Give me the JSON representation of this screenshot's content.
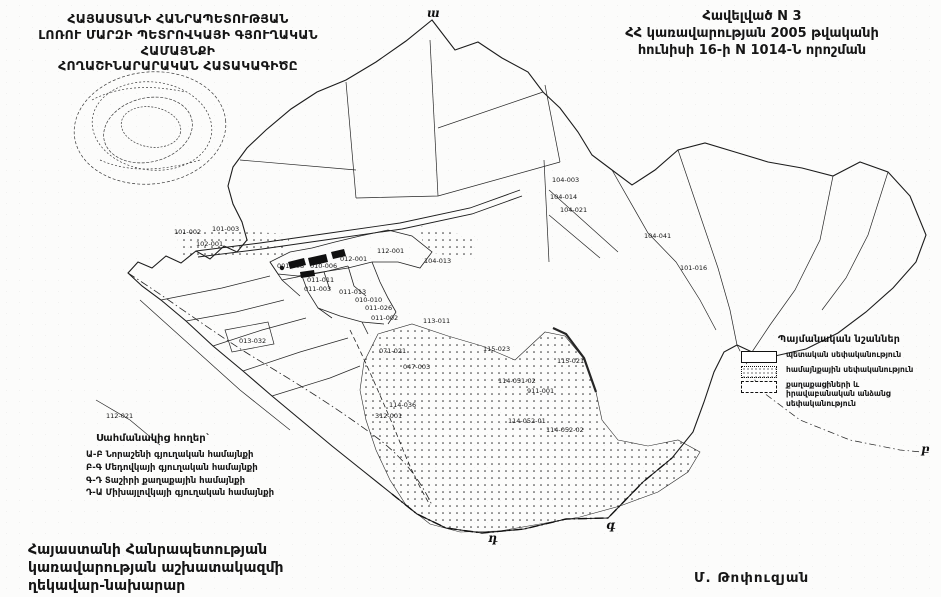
{
  "title": {
    "lines": [
      "ՀԱՅԱՍՏԱՆԻ ՀԱՆՐԱՊԵՏՈՒԹՅԱՆ",
      "ԼՈՌՈՒ ՄԱՐԶԻ ՊԵՏՐՈՎԿԱՅԻ ԳՅՈՒՂԱԿԱՆ ՀԱՄԱՅՆՔԻ",
      "ՀՈՂԱՇԻՆԱՐԱՐԱԿԱՆ ՀԱՏԱԿԱԳԻԾԸ"
    ]
  },
  "decree": {
    "lines": [
      "Հավելված N 3",
      "ՀՀ կառավարության 2005 թվականի",
      "հունիսի 16-ի N 1014-Ն որոշման"
    ]
  },
  "legend": {
    "header": "Պայմանական նշաններ",
    "items": [
      {
        "symbol": "solid-box-icon",
        "label": "պետական սեփականություն"
      },
      {
        "symbol": "dotted-box-icon",
        "label": "համայնքային սեփականություն"
      },
      {
        "symbol": "dashed-box-icon",
        "label": "քաղաքացիների և իրավաբանական անձանց սեփականություն"
      }
    ]
  },
  "neighbors": {
    "header": "Սահմանակից հողեր`",
    "items": [
      "Ա-Բ Նորաշենի գյուղական համայնքի",
      "Բ-Գ Մեդովկայի գյուղական համայնքի",
      "Գ-Դ Տաշիրի քաղաքային համայնքի",
      "Դ-Ա Միխայլովկայի գյուղական համայնքի"
    ]
  },
  "signatory": {
    "lines": [
      "Հայաստանի Հանրապետության",
      "կառավարության աշխատակազմի",
      "ղեկավար-նախարար"
    ],
    "name": "Մ. Թոփուզյան"
  },
  "map": {
    "boundary_letters": [
      {
        "char": "ա",
        "x": 427,
        "y": 6
      },
      {
        "char": "բ",
        "x": 921,
        "y": 442
      },
      {
        "char": "գ",
        "x": 606,
        "y": 518
      },
      {
        "char": "դ",
        "x": 488,
        "y": 531
      }
    ],
    "parcel_labels": [
      {
        "text": "104-003",
        "x": 552,
        "y": 177
      },
      {
        "text": "104-014",
        "x": 550,
        "y": 194
      },
      {
        "text": "104-021",
        "x": 560,
        "y": 207
      },
      {
        "text": "104-041",
        "x": 644,
        "y": 233
      },
      {
        "text": "101-016",
        "x": 680,
        "y": 265
      },
      {
        "text": "101-002",
        "x": 174,
        "y": 229
      },
      {
        "text": "101-003",
        "x": 212,
        "y": 226
      },
      {
        "text": "102-001",
        "x": 196,
        "y": 241
      },
      {
        "text": "001-008",
        "x": 277,
        "y": 263
      },
      {
        "text": "010-006",
        "x": 310,
        "y": 263
      },
      {
        "text": "012-001",
        "x": 340,
        "y": 256
      },
      {
        "text": "112-001",
        "x": 377,
        "y": 248
      },
      {
        "text": "104-013",
        "x": 424,
        "y": 258
      },
      {
        "text": "011-011",
        "x": 307,
        "y": 277
      },
      {
        "text": "011-003",
        "x": 304,
        "y": 286
      },
      {
        "text": "011-013",
        "x": 339,
        "y": 289
      },
      {
        "text": "010-010",
        "x": 355,
        "y": 297
      },
      {
        "text": "011-026",
        "x": 365,
        "y": 305
      },
      {
        "text": "011-002",
        "x": 371,
        "y": 315
      },
      {
        "text": "013-032",
        "x": 239,
        "y": 338
      },
      {
        "text": "113-011",
        "x": 423,
        "y": 318
      },
      {
        "text": "071-021",
        "x": 379,
        "y": 348
      },
      {
        "text": "047-003",
        "x": 403,
        "y": 364
      },
      {
        "text": "115-023",
        "x": 483,
        "y": 346
      },
      {
        "text": "115-021",
        "x": 557,
        "y": 358
      },
      {
        "text": "114-051-02",
        "x": 498,
        "y": 378
      },
      {
        "text": "911-001",
        "x": 527,
        "y": 388
      },
      {
        "text": "114-036",
        "x": 389,
        "y": 402
      },
      {
        "text": "312-001",
        "x": 375,
        "y": 413
      },
      {
        "text": "114-052-01",
        "x": 508,
        "y": 418
      },
      {
        "text": "114-052-02",
        "x": 546,
        "y": 427
      },
      {
        "text": "112-021",
        "x": 106,
        "y": 413
      }
    ]
  }
}
